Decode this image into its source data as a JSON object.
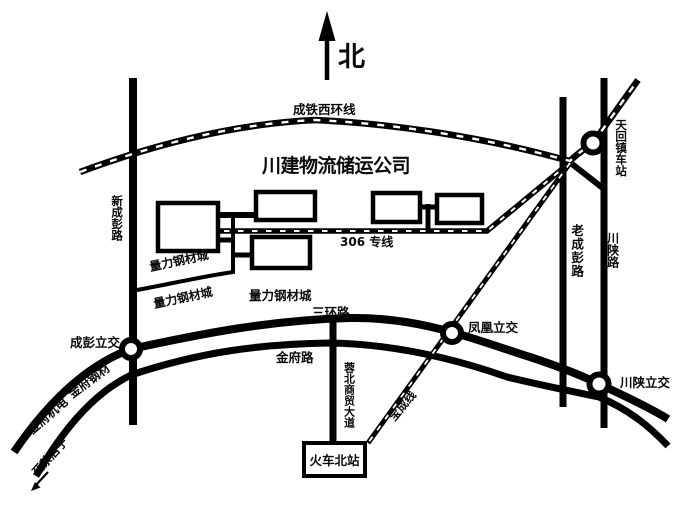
{
  "compass": {
    "north_label": "北"
  },
  "company": {
    "title": "川建物流储运公司"
  },
  "railways": {
    "west_ring": "成铁西环线",
    "line_306": "306 专线",
    "baocheng": "宝成线"
  },
  "roads": {
    "xin_chengpeng": "新成彭路",
    "lao_chengpeng": "老成彭路",
    "chuanshan": "川陕路",
    "third_ring": "三环路",
    "jinfu": "金府路",
    "rongbei_avenue": "蓉北商贸大道"
  },
  "interchanges": {
    "chengpeng": "成彭立交",
    "fenghuang": "凤凰立交",
    "chuanshan": "川陕立交"
  },
  "stations": {
    "tianhui": "天回镇车站",
    "north_railway": "火车北站"
  },
  "areas": {
    "liangli_steel_city": "量力钢材城",
    "jinfu_steel": "金府钢材",
    "jinfu_mech": "金府机电"
  },
  "signs": {
    "to_chadianzi": "至茶店子"
  },
  "colors": {
    "ink": "#000000",
    "background": "#ffffff"
  }
}
